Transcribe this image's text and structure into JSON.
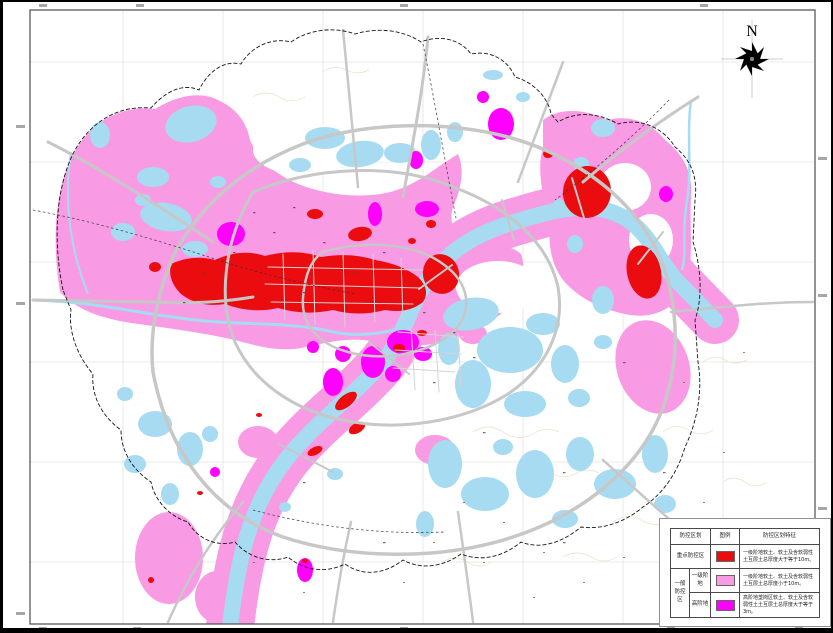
{
  "map": {
    "north_label": "N"
  },
  "legend": {
    "header": {
      "zone": "防控区划",
      "symbol": "图例",
      "feature": "防控区划特征"
    },
    "rows": [
      {
        "zone": "重点防控区",
        "sub": "",
        "color": "#EA0C0E",
        "feature": "一级阶地软土、软土及含软弱性土互层土总厚度大于等于10m。"
      },
      {
        "zone": "一般防控区",
        "sub": "一级阶地",
        "color": "#F89BE4",
        "feature": "一级阶地软土、软土及含软弱性土互层土总厚度小于10m。"
      },
      {
        "zone": "一般防控区",
        "sub": "高阶地",
        "color": "#FF00FF",
        "feature": "高阶地垄岗区软土、软土及含软弱性土土互层土总厚度大于等于3m。"
      }
    ]
  },
  "colors": {
    "key_zone_red": "#EA0C0E",
    "general_zone_pink": "#F89BE4",
    "high_terrace_magenta": "#FF00FF",
    "water_blue": "#A6DBF2",
    "road_gray": "#C7C7C7",
    "road_minor_gray": "#D4D4D4",
    "boundary_black": "#161616",
    "contour_beige": "#E6DFC2",
    "grid_gray": "#E4E4E4",
    "frame_gray": "#4d4d4d",
    "mark_dark": "#4a4a4a",
    "mark_brown": "#A0622D",
    "tick_gray": "#8a8a8a"
  }
}
